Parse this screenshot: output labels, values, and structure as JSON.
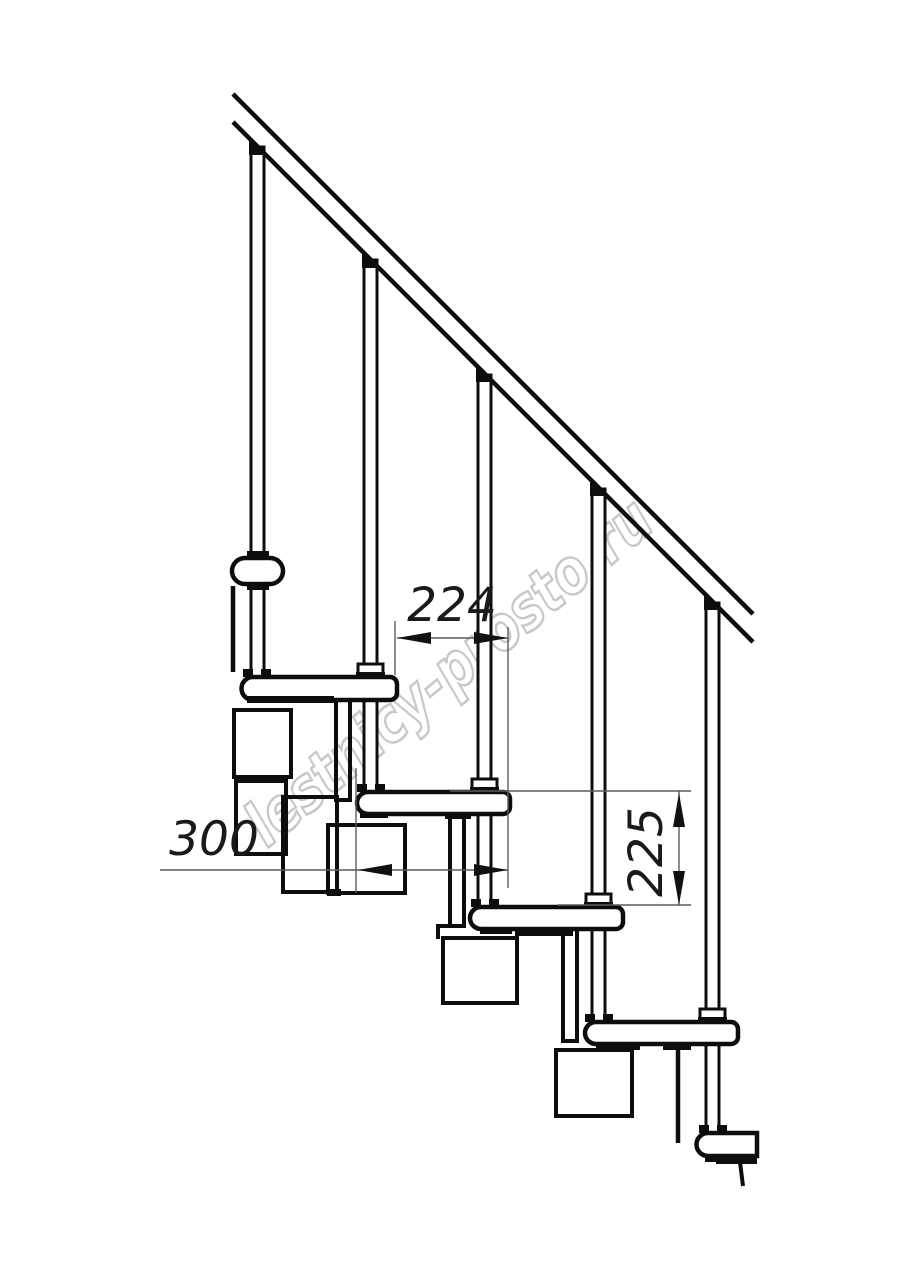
{
  "title": "Modular staircase side-view technical drawing",
  "watermark": {
    "text": "lestnicy-prosto.ru",
    "color": "#c6c6c6"
  },
  "dimensions": {
    "run": "224",
    "depth": "300",
    "rise": "225"
  },
  "colors": {
    "line": "#0d0d0d",
    "dim_line": "#5c5c5c",
    "watermark": "#c6c6c6",
    "background": "#ffffff"
  }
}
